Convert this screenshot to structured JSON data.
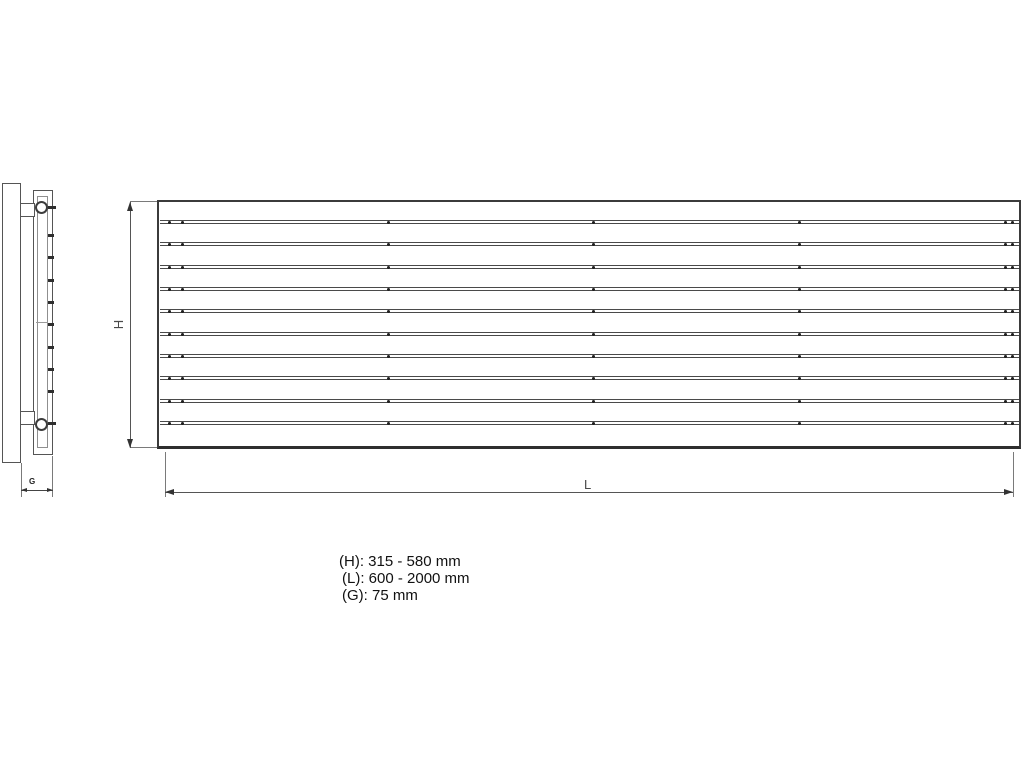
{
  "labels": {
    "height_dim": "H",
    "length_dim": "L",
    "depth_dim": "G"
  },
  "specs": {
    "height_range": "(H): 315 - 580 mm",
    "length_range": "(L): 600 - 2000 mm",
    "depth_value": "(G): 75 mm"
  },
  "front_view": {
    "slat_count": 10,
    "first_slat_y": 220,
    "slat_spacing": 22.33,
    "dot_offsets": [
      8,
      21,
      227,
      432,
      638,
      844,
      851
    ]
  },
  "side_view": {
    "tick_count": 8,
    "first_tick_y": 234,
    "tick_spacing": 22.3
  },
  "colors": {
    "background": "#ffffff",
    "line_dark": "#3b3b3b",
    "line_mid": "#5a5a5a",
    "line_light": "#8f8f8f"
  }
}
